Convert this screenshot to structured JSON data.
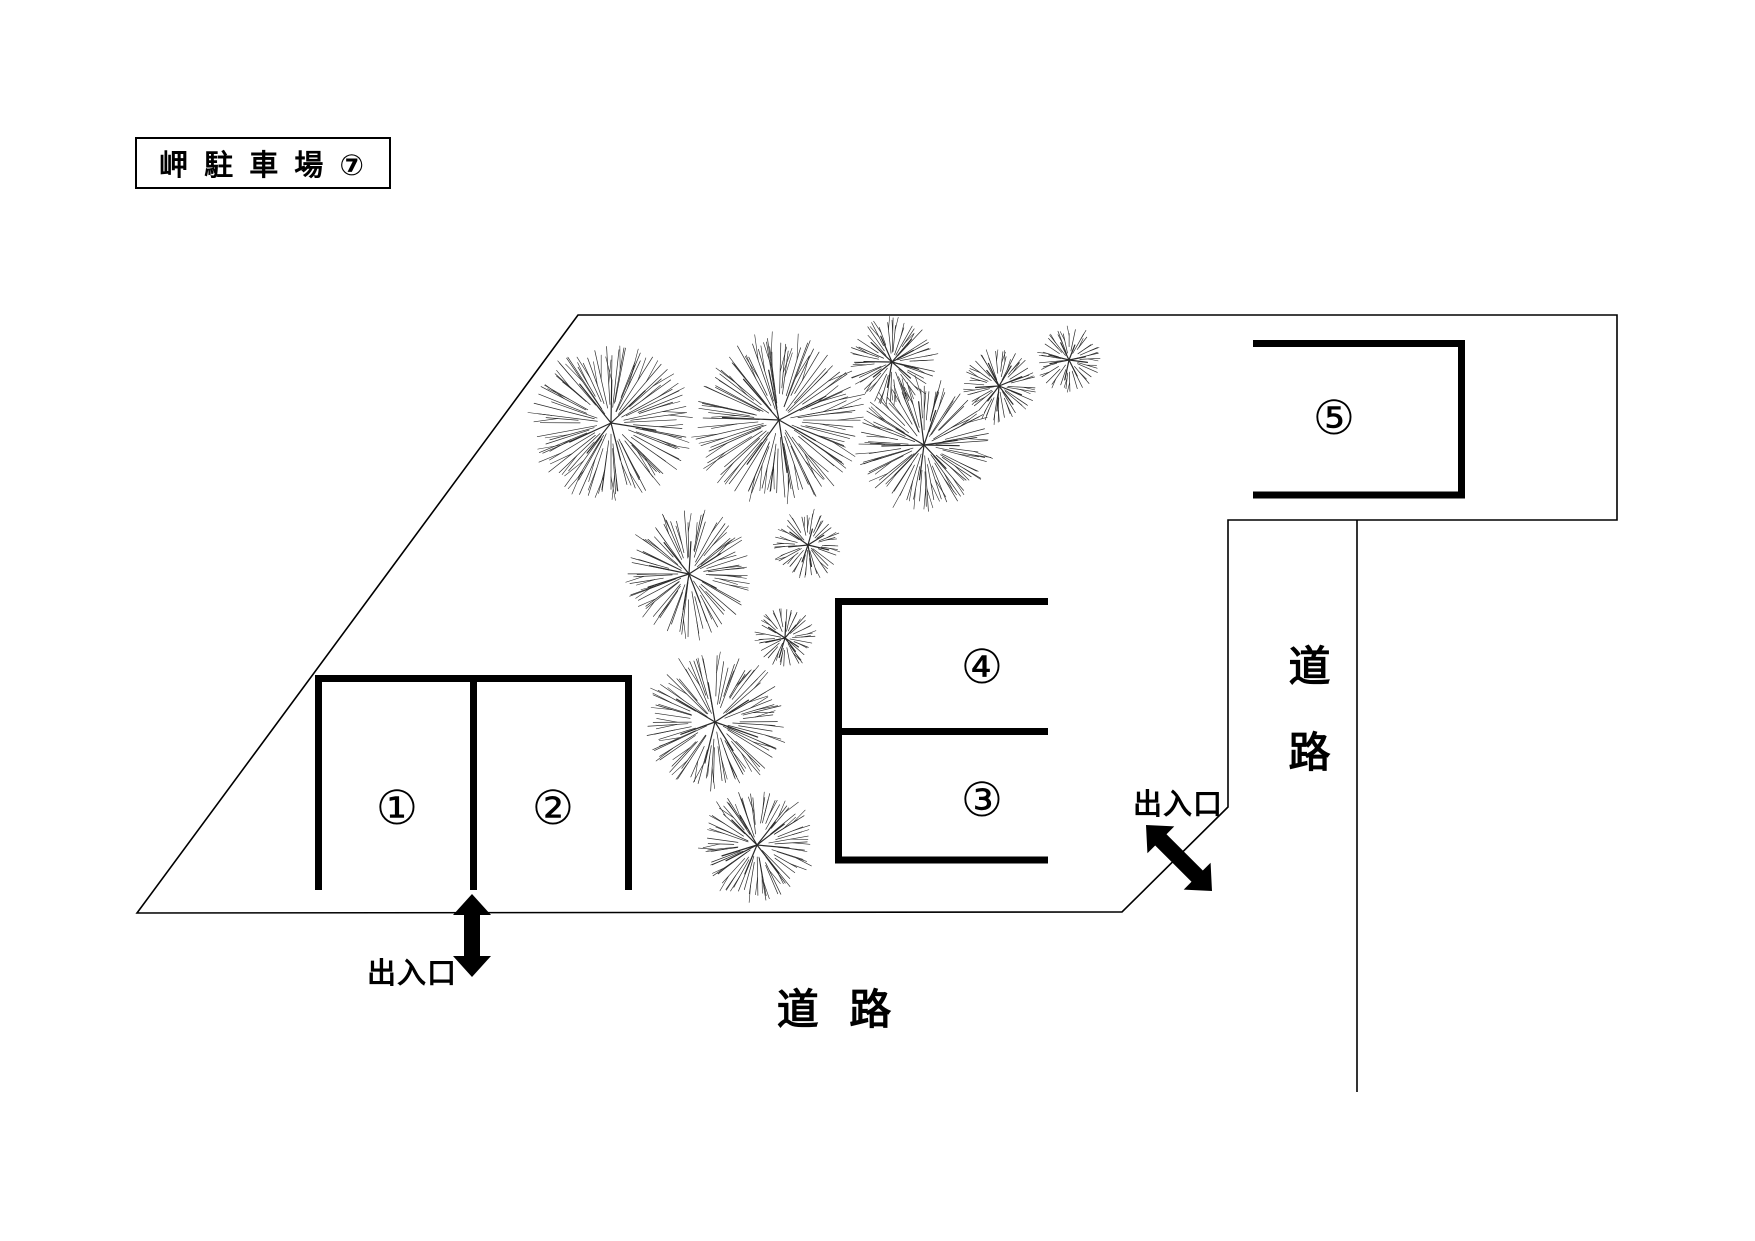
{
  "title": "岬 駐 車 場 ⑦",
  "labels": {
    "road_right": "道路",
    "road_bottom": "道 路",
    "entrance_bottom": "出入口",
    "entrance_right": "出入口"
  },
  "parking_spots": [
    {
      "id": "1",
      "label": "①",
      "x": 397,
      "y": 808
    },
    {
      "id": "2",
      "label": "②",
      "x": 553,
      "y": 808
    },
    {
      "id": "3",
      "label": "③",
      "x": 982,
      "y": 800
    },
    {
      "id": "4",
      "label": "④",
      "x": 982,
      "y": 667
    },
    {
      "id": "5",
      "label": "⑤",
      "x": 1334,
      "y": 418
    }
  ],
  "colors": {
    "ink": "#000000",
    "tree": "#2a2a2a",
    "background": "#ffffff"
  },
  "diagram": {
    "width": 1755,
    "height": 1241,
    "boundary_polygon": [
      [
        578,
        315
      ],
      [
        1617,
        315
      ],
      [
        1617,
        520
      ],
      [
        1228,
        520
      ],
      [
        1228,
        807
      ],
      [
        1122,
        912
      ],
      [
        137,
        913
      ]
    ],
    "road_edge_line": {
      "x1": 1357,
      "y1": 520,
      "x2": 1357,
      "y2": 1092
    },
    "stall_lines": [
      {
        "x1": 315,
        "y1": 678.5,
        "x2": 632,
        "y2": 678.5
      },
      {
        "x1": 318.5,
        "y1": 675,
        "x2": 318.5,
        "y2": 890
      },
      {
        "x1": 473.5,
        "y1": 682,
        "x2": 473.5,
        "y2": 890
      },
      {
        "x1": 628.5,
        "y1": 682,
        "x2": 628.5,
        "y2": 890
      },
      {
        "x1": 838.5,
        "y1": 598,
        "x2": 838.5,
        "y2": 863
      },
      {
        "x1": 835,
        "y1": 601.5,
        "x2": 1048,
        "y2": 601.5
      },
      {
        "x1": 842,
        "y1": 731.5,
        "x2": 1048,
        "y2": 731.5
      },
      {
        "x1": 835,
        "y1": 860,
        "x2": 1048,
        "y2": 860
      },
      {
        "x1": 1253,
        "y1": 343.5,
        "x2": 1465,
        "y2": 343.5
      },
      {
        "x1": 1253,
        "y1": 495,
        "x2": 1465,
        "y2": 495
      },
      {
        "x1": 1461.5,
        "y1": 340,
        "x2": 1461.5,
        "y2": 498
      }
    ],
    "entrance_arrows": [
      {
        "x1": 472,
        "y1": 894,
        "x2": 472,
        "y2": 977
      },
      {
        "x1": 1146,
        "y1": 825,
        "x2": 1212,
        "y2": 891
      }
    ],
    "trees": [
      {
        "x": 611,
        "y": 423,
        "r": 75
      },
      {
        "x": 779,
        "y": 420,
        "r": 81
      },
      {
        "x": 892,
        "y": 362,
        "r": 42
      },
      {
        "x": 924,
        "y": 445,
        "r": 63
      },
      {
        "x": 999,
        "y": 386,
        "r": 35
      },
      {
        "x": 1069,
        "y": 360,
        "r": 31
      },
      {
        "x": 689,
        "y": 574,
        "r": 60
      },
      {
        "x": 808,
        "y": 545,
        "r": 33
      },
      {
        "x": 785,
        "y": 638,
        "r": 29
      },
      {
        "x": 715,
        "y": 722,
        "r": 66
      },
      {
        "x": 757,
        "y": 845,
        "r": 54
      }
    ]
  }
}
